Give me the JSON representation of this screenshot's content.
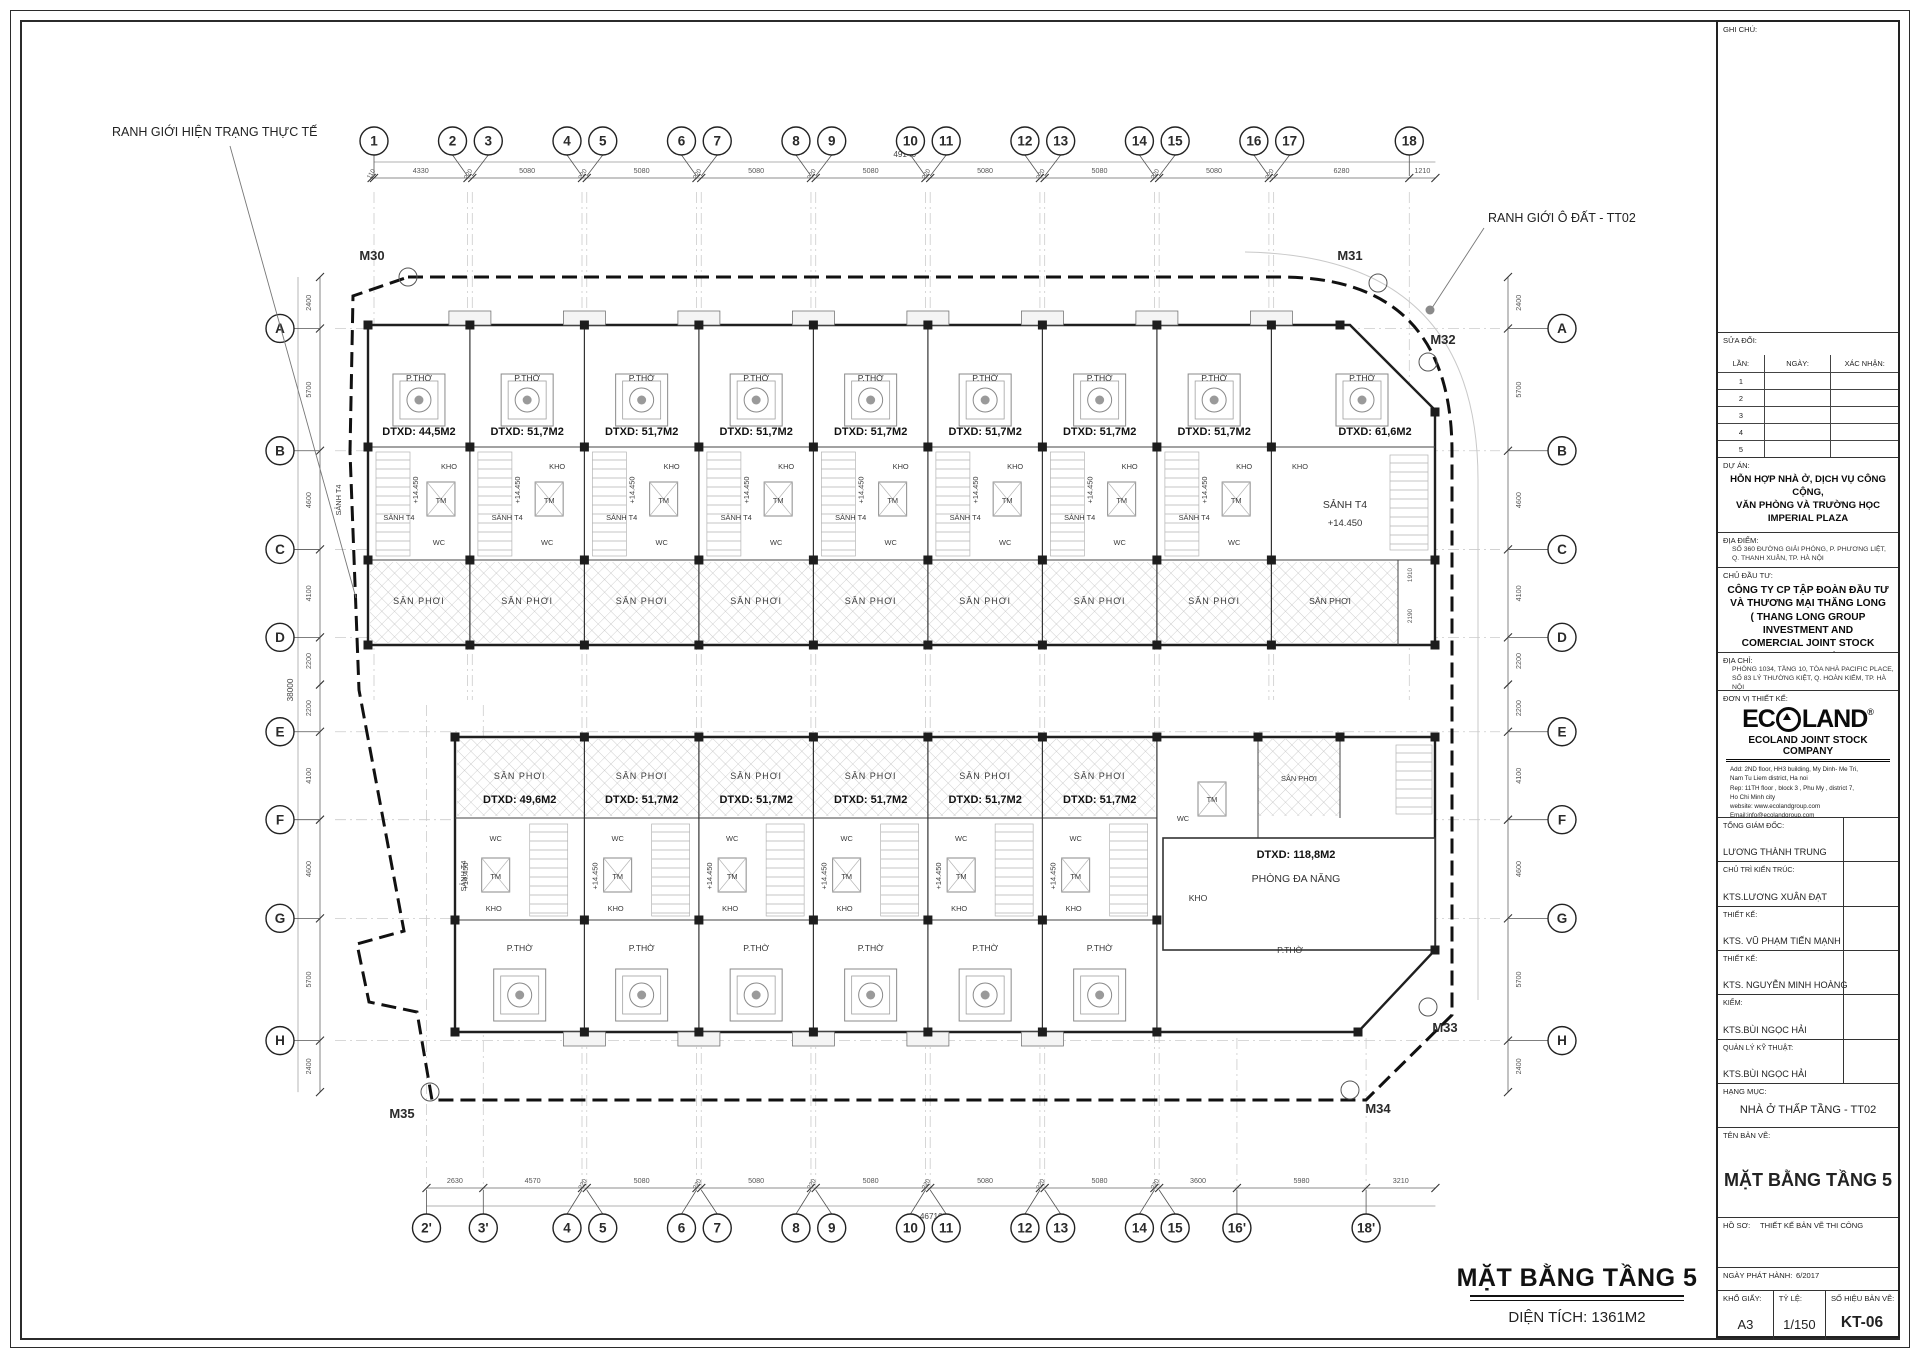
{
  "notes": {
    "existing_boundary": "RANH GIỚI HIỆN TRẠNG THỰC TẾ",
    "plot_boundary": "RANH GIỚI Ô ĐẤT - TT02"
  },
  "plan_title": {
    "main": "MẶT BẰNG TẦNG 5",
    "area": "DIỆN TÍCH: 1361M2"
  },
  "markers": {
    "m30": "M30",
    "m31": "M31",
    "m32": "M32",
    "m33": "M33",
    "m34": "M34",
    "m35": "M35"
  },
  "grid_top": {
    "bubbles": [
      "1",
      "2",
      "3",
      "4",
      "5",
      "6",
      "7",
      "8",
      "9",
      "10",
      "11",
      "12",
      "13",
      "14",
      "15",
      "16",
      "17",
      "18"
    ],
    "bubbles_mm": [
      0,
      4330,
      4550,
      9630,
      9850,
      14930,
      15150,
      20230,
      20450,
      25530,
      25750,
      30830,
      31050,
      36130,
      36350,
      41430,
      41650,
      47930
    ],
    "ticks_mm": [
      -110,
      0,
      4330,
      4550,
      9630,
      9850,
      14930,
      15150,
      20230,
      20450,
      25530,
      25750,
      30830,
      31050,
      36130,
      36350,
      41430,
      41650,
      47930,
      49140
    ],
    "dims": [
      "110",
      "4330",
      "220",
      "5080",
      "220",
      "5080",
      "220",
      "5080",
      "220",
      "5080",
      "220",
      "5080",
      "220",
      "5080",
      "220",
      "5080",
      "220",
      "6280",
      "1210"
    ],
    "overall": "49140"
  },
  "grid_bottom": {
    "bubbles": [
      "2'",
      "3'",
      "4",
      "5",
      "6",
      "7",
      "8",
      "9",
      "10",
      "11",
      "12",
      "13",
      "14",
      "15",
      "16'",
      "18'"
    ],
    "bubbles_mm": [
      2430,
      5060,
      9630,
      9850,
      14930,
      15150,
      20230,
      20450,
      25530,
      25750,
      30830,
      31050,
      36130,
      36350,
      39950,
      45930
    ],
    "ticks_mm": [
      2430,
      5060,
      9630,
      9850,
      14930,
      15150,
      20230,
      20450,
      25530,
      25750,
      30830,
      31050,
      36130,
      36350,
      39950,
      45930,
      49140
    ],
    "dims": [
      "2630",
      "4570",
      "220",
      "5080",
      "220",
      "5080",
      "220",
      "5080",
      "220",
      "5080",
      "220",
      "5080",
      "220",
      "3600",
      "5980",
      "3210"
    ],
    "overall": "46710"
  },
  "grid_side": {
    "bubbles": [
      "A",
      "B",
      "C",
      "D",
      "E",
      "F",
      "G",
      "H"
    ],
    "bubbles_mm": [
      2400,
      8100,
      12700,
      16800,
      21200,
      25300,
      29900,
      35600
    ],
    "ticks_mm": [
      0,
      2400,
      8100,
      12700,
      16800,
      19000,
      21200,
      25300,
      29900,
      35600,
      38000
    ],
    "dims": [
      "2400",
      "5700",
      "4600",
      "4100",
      "2200",
      "2200",
      "4100",
      "4600",
      "5700",
      "2400"
    ],
    "overall": "38000"
  },
  "rooms": {
    "worship": "P.THỜ",
    "storage": "KHO",
    "lift": "TM",
    "wc": "WC",
    "lobby": "SẢNH T4",
    "level": "+14.450",
    "yard": "SÂN PHƠI"
  },
  "upper_units": [
    "DTXD: 44,5M2",
    "DTXD: 51,7M2",
    "DTXD: 51,7M2",
    "DTXD: 51,7M2",
    "DTXD: 51,7M2",
    "DTXD: 51,7M2",
    "DTXD: 51,7M2",
    "DTXD: 51,7M2",
    "DTXD: 61,6M2"
  ],
  "lower_units": [
    "DTXD: 49,6M2",
    "DTXD: 51,7M2",
    "DTXD: 51,7M2",
    "DTXD: 51,7M2",
    "DTXD: 51,7M2",
    "DTXD: 51,7M2"
  ],
  "multi_room": {
    "area": "DTXD: 118,8M2",
    "name": "PHÒNG ĐA NĂNG"
  },
  "side_small_dims": [
    "1910",
    "2190"
  ],
  "titleblock": {
    "ghi_chu": "GHI CHÚ:",
    "sua_doi": "SỬA ĐỔI:",
    "rev_cols": [
      "LẦN:",
      "NGÀY:",
      "XÁC NHẬN:"
    ],
    "rev_rows": [
      "1",
      "2",
      "3",
      "4",
      "5"
    ],
    "du_an_label": "DỰ ÁN:",
    "du_an": [
      "HỖN HỢP NHÀ Ở, DỊCH VỤ CÔNG CỘNG,",
      "VĂN PHÒNG VÀ TRƯỜNG HỌC",
      "IMPERIAL PLAZA"
    ],
    "dia_diem_label": "ĐỊA ĐIỂM:",
    "dia_diem": [
      "SỐ 360 ĐƯỜNG GIẢI PHÓNG, P. PHƯƠNG LIỆT,",
      "Q. THANH XUÂN, TP. HÀ NỘI"
    ],
    "chu_dau_tu_label": "CHỦ ĐẦU TƯ:",
    "chu_dau_tu": [
      "CÔNG TY CP TẬP ĐOÀN ĐẦU TƯ",
      "VÀ THƯƠNG MẠI THĂNG LONG",
      "( THANG LONG GROUP INVESTMENT AND",
      "COMERCIAL JOINT STOCK COMPANY )"
    ],
    "dia_chi_label": "ĐỊA CHỈ:",
    "dia_chi": [
      "PHÒNG 1034, TẦNG 10, TÒA NHÀ PACIFIC PLACE,",
      "SỐ 83 LÝ THƯỜNG KIỆT, Q. HOÀN KIẾM, TP. HÀ NỘI"
    ],
    "don_vi_label": "ĐƠN VỊ THIẾT KẾ:",
    "logo_ec": "EC",
    "logo_land": "LAND",
    "logo_r": "®",
    "logo_company": "ECOLAND JOINT STOCK COMPANY",
    "logo_addr": [
      "Add: 2ND floor, HH3 building, My Dinh- Me Tri,",
      "Nam Tu Liem district, Ha noi",
      "Rep: 11TH floor , block 3 , Phu My , district 7,",
      "Ho Chi Minh city",
      "website: www.ecolandgroup.com",
      "Email:info@ecolandgroup.com"
    ],
    "personnel": [
      {
        "label": "TỔNG GIÁM ĐỐC:",
        "name": "LƯƠNG THÀNH TRUNG"
      },
      {
        "label": "CHỦ TRÌ KIẾN TRÚC:",
        "name": "KTS.LƯƠNG XUÂN ĐẠT"
      },
      {
        "label": "THIẾT KẾ:",
        "name": "KTS. VŨ PHẠM TIẾN MẠNH"
      },
      {
        "label": "THIẾT KẾ:",
        "name": "KTS. NGUYỄN MINH HOÀNG"
      },
      {
        "label": "KIỂM:",
        "name": "KTS.BÙI NGỌC HẢI"
      },
      {
        "label": "QUẢN LÝ KỸ THUẬT:",
        "name": "KTS.BÙI NGỌC HẢI"
      }
    ],
    "hang_muc_label": "HẠNG MỤC:",
    "hang_muc": "NHÀ Ở THẤP TẦNG - TT02",
    "ten_ban_ve_label": "TÊN BẢN VẼ:",
    "ten_ban_ve": "MẶT BẰNG TẦNG 5",
    "ho_so_label": "HỒ SƠ:",
    "ho_so": "THIẾT KẾ BẢN VẼ THI CÔNG",
    "ngay_label": "NGÀY PHÁT HÀNH:",
    "ngay": "6/2017",
    "kho_giay_label": "KHỔ GIẤY:",
    "kho_giay": "A3",
    "ty_le_label": "TỶ LỆ:",
    "ty_le": "1/150",
    "so_hieu_label": "SỐ HIỆU BẢN VẼ:",
    "so_hieu": "KT-06"
  }
}
